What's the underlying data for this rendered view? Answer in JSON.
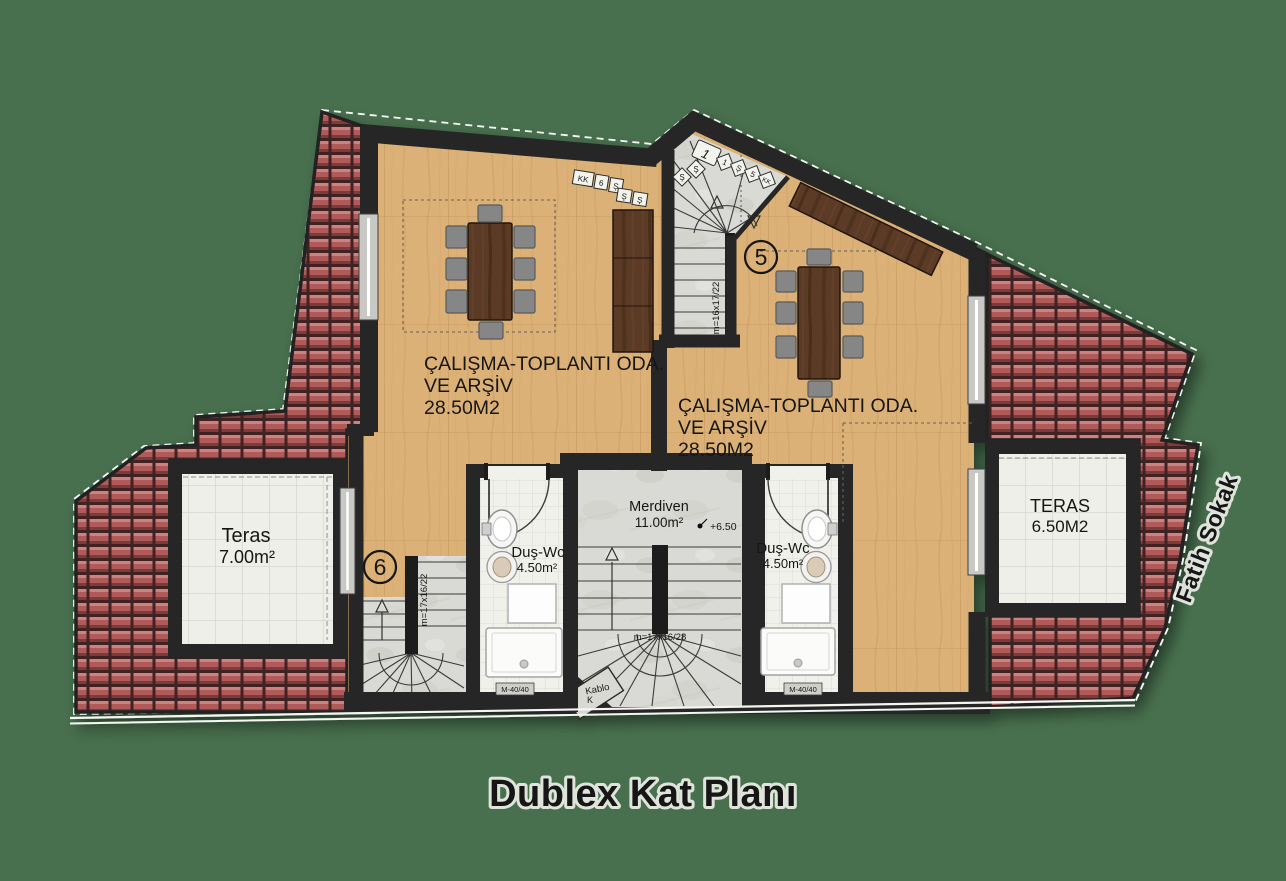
{
  "title": "Dublex Kat Planı",
  "street_label": "Fatih Sokak",
  "plan": {
    "units": {
      "left": {
        "badge": "6",
        "office_line1": "ÇALIŞMA-TOPLANTI ODA.",
        "office_line2": "VE ARŞİV",
        "office_area": "28.50M2",
        "terrace_name": "Teras",
        "terrace_area": "7.00m²",
        "bath_name": "Duş-Wc",
        "bath_area": "4.50m²",
        "stair_spec": "m=17x16/22"
      },
      "right": {
        "badge": "5",
        "office_line1": "ÇALIŞMA-TOPLANTI ODA.",
        "office_line2": "VE ARŞİV",
        "office_area": "28.50M2",
        "terrace_name": "TERAS",
        "terrace_area": "6.50M2",
        "bath_name": "Duş-Wc",
        "bath_area": "4.50m²",
        "stair_spec": "m=16x17/22"
      }
    },
    "stair_hall": {
      "name": "Merdiven",
      "area": "11.00m²",
      "level_mark": "+6.50",
      "stair_spec": "m=17x16/28",
      "cable_label": "Kablo",
      "cable_label_short": "K"
    },
    "column_marks": {
      "left": "M-40/40",
      "right": "M-40/40"
    },
    "tag_boxes": {
      "left_room": [
        "KK",
        "6",
        "Ş",
        "Ş",
        "Ş"
      ],
      "tower_main": "1",
      "tower_row": [
        "1",
        "Ş",
        "5",
        "KK"
      ],
      "tower_side": [
        "Ş",
        "Ş"
      ]
    }
  },
  "colors": {
    "background": "#48704e",
    "roof_tile": "#b05a5a",
    "wood_floor": "#dcb177",
    "walnut_furniture": "#5b3a26",
    "marble_stair": "#d9dad5",
    "ceramic_tile": "#efefe9",
    "wall": "#262626",
    "text": "#161616"
  }
}
